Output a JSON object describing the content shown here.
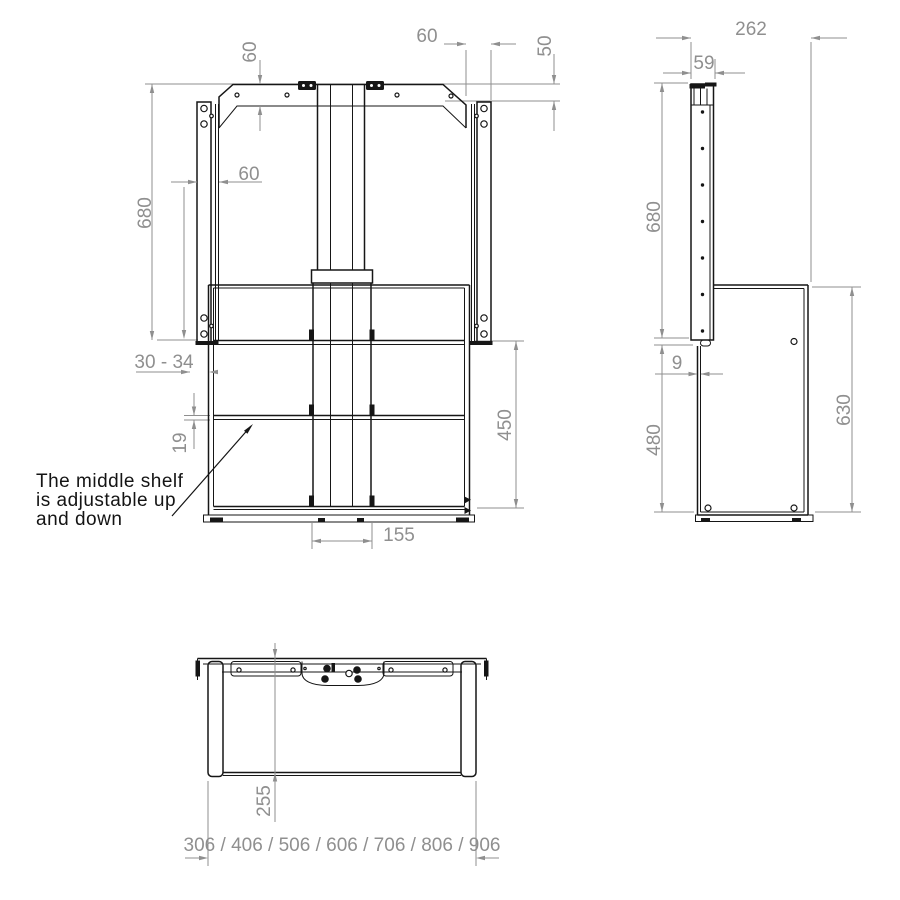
{
  "note": {
    "line1": "The middle shelf",
    "line2": "is adjustable up",
    "line3": "and down"
  },
  "front": {
    "plate_height": "60",
    "top_offset": "60",
    "bracket_drop": "50",
    "column_height": "680",
    "rail_width": "60",
    "wall_gap": "30 - 34",
    "shelf_thickness": "19",
    "shelf_area_height": "450",
    "column_width": "155"
  },
  "side": {
    "depth": "262",
    "column_depth": "59",
    "column_height": "680",
    "panel_thickness": "9",
    "lower_height": "480",
    "cabinet_height": "630"
  },
  "top": {
    "cabinet_depth": "255",
    "width_options": "306 / 406 / 506 / 606 / 706 / 806 / 906"
  }
}
